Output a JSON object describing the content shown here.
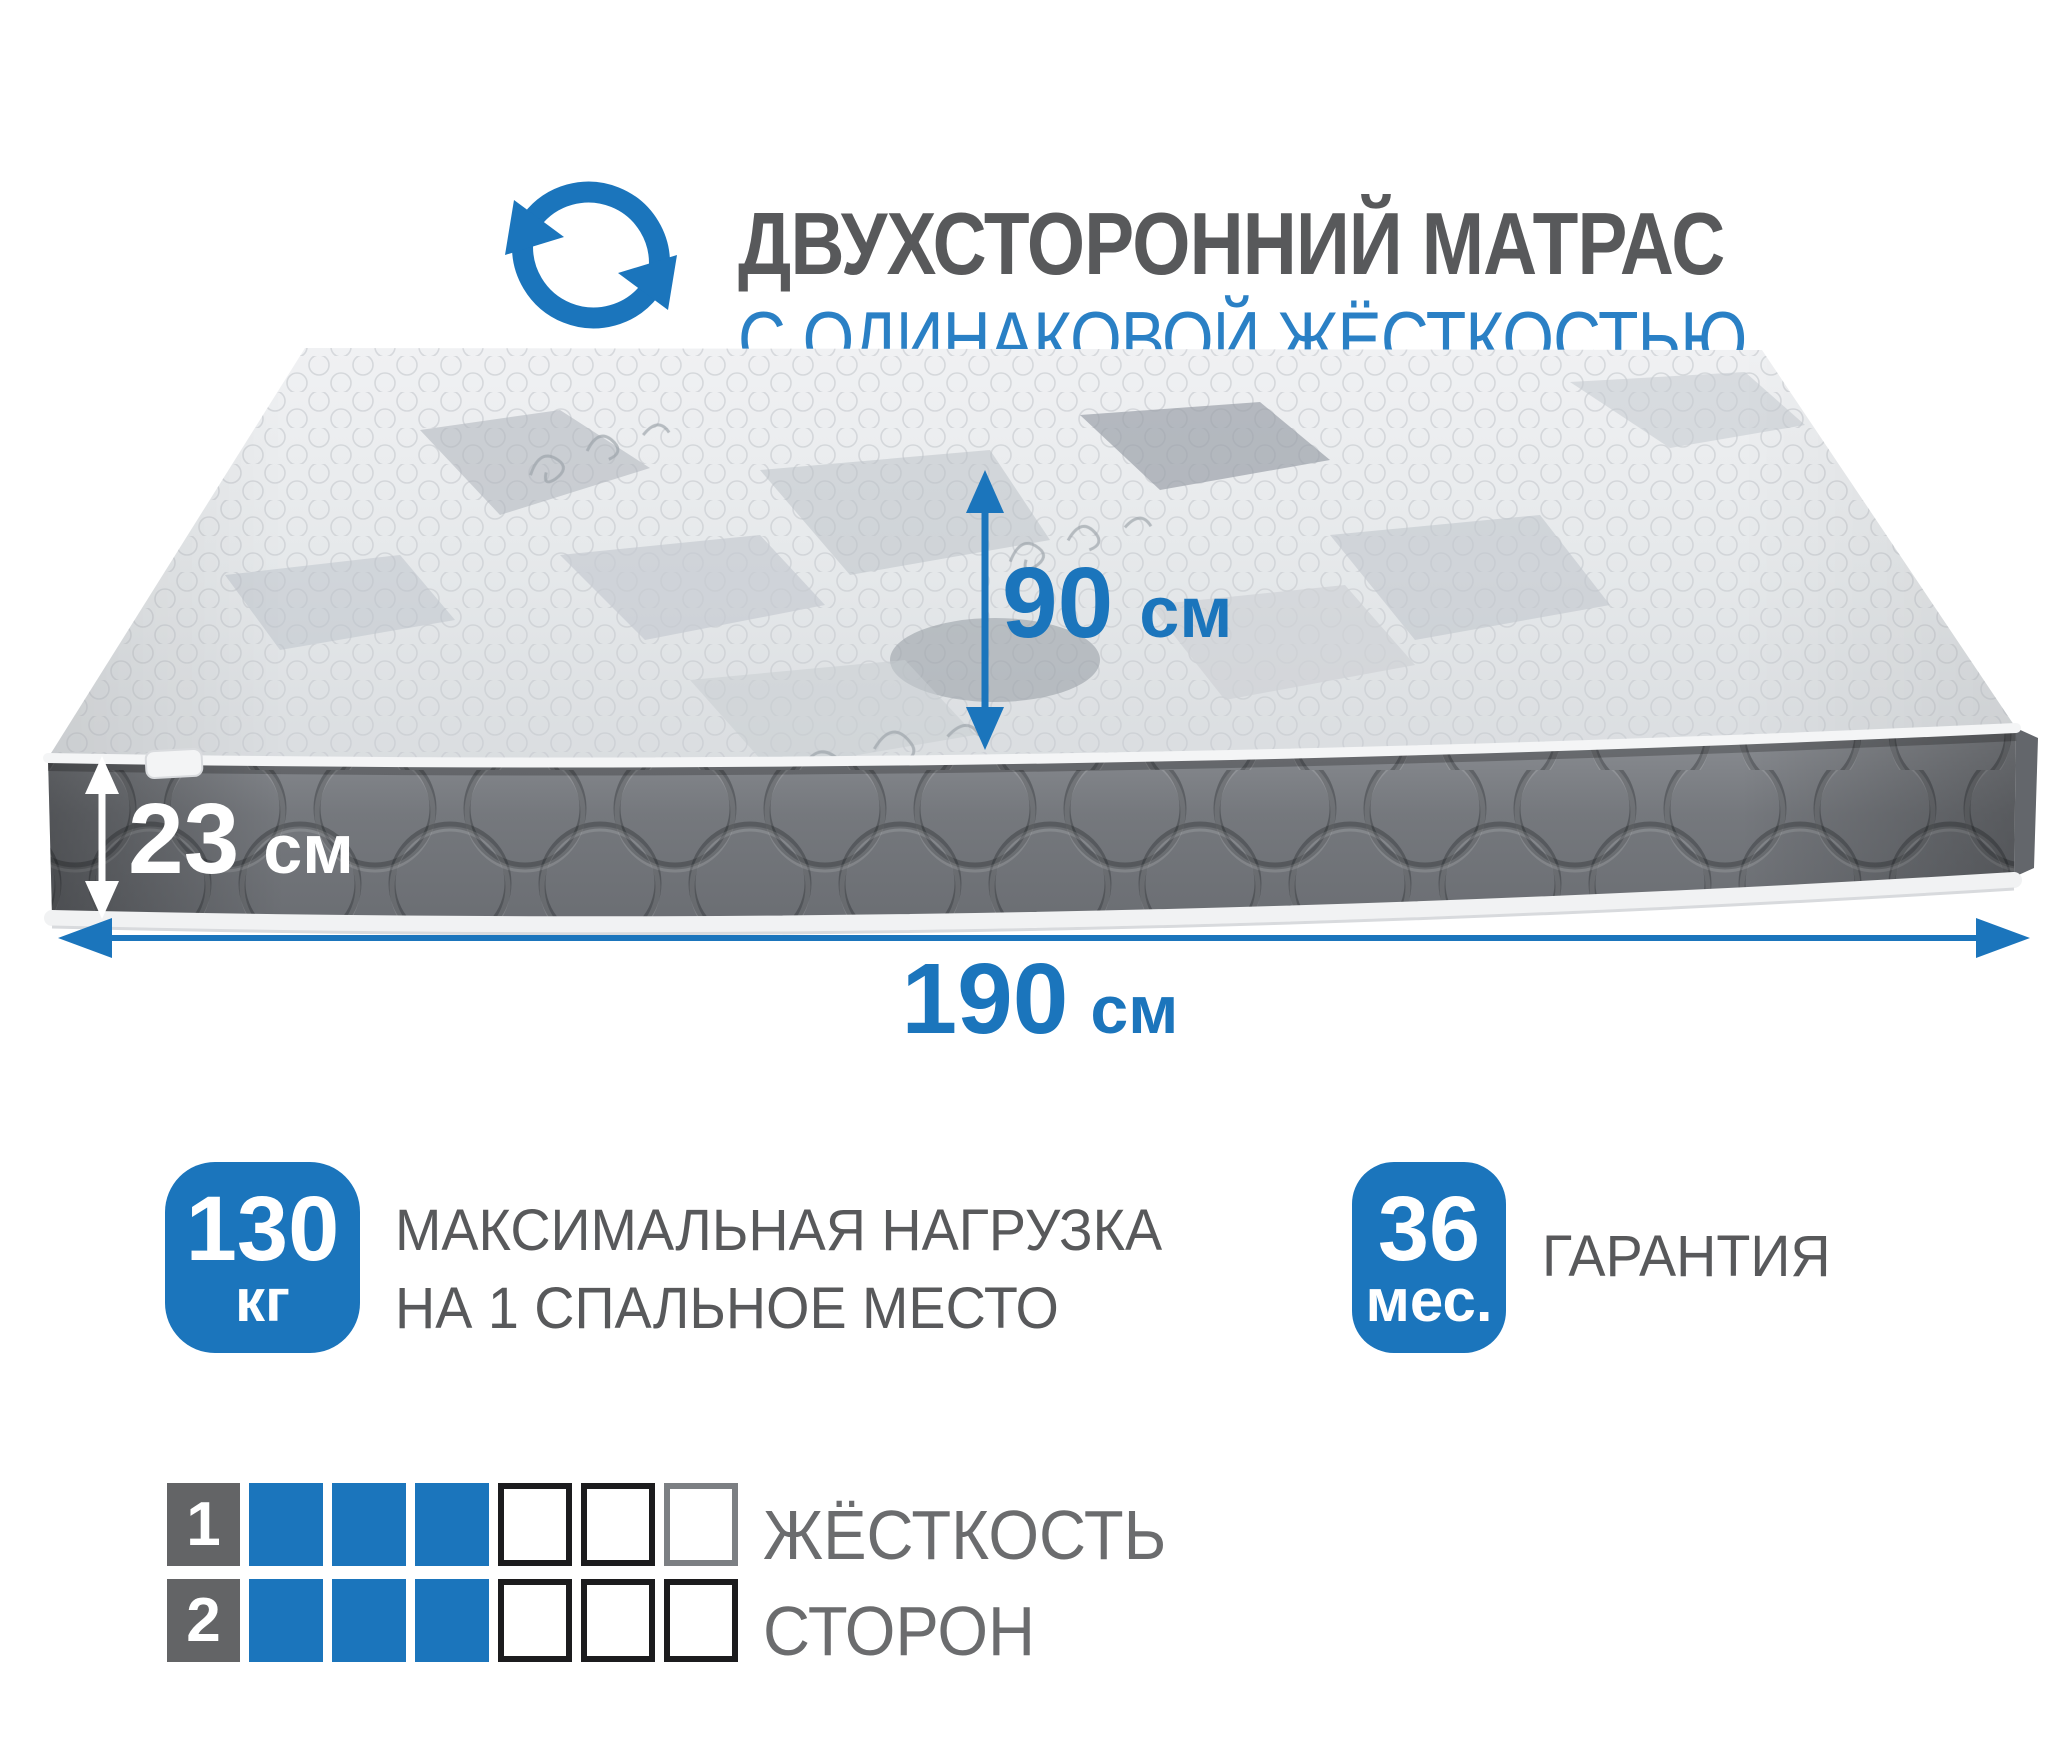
{
  "header": {
    "title": "ДВУХСТОРОННИЙ МАТРАС",
    "subtitle": "С ОДИНАКОВОЙ ЖЁСТКОСТЬЮ",
    "icon": "rotate-arrows-icon"
  },
  "dimensions": {
    "width": {
      "value": "90",
      "unit": "см"
    },
    "height": {
      "value": "23",
      "unit": "см"
    },
    "length": {
      "value": "190",
      "unit": "см"
    }
  },
  "features": [
    {
      "badge_value": "130",
      "badge_unit": "кг",
      "label_line1": "МАКСИМАЛЬНАЯ НАГРУЗКА",
      "label_line2": "НА 1 СПАЛЬНОЕ МЕСТО"
    },
    {
      "badge_value": "36",
      "badge_unit": "мес.",
      "label_line1": "ГАРАНТИЯ"
    }
  ],
  "firmness": {
    "label_line1": "ЖЁСТКОСТЬ",
    "label_line2": "СТОРОН",
    "rows": [
      {
        "side": "1",
        "filled": 3,
        "total": 6
      },
      {
        "side": "2",
        "filled": 3,
        "total": 6
      }
    ]
  },
  "colors": {
    "accent_blue": "#1b75bc",
    "header_blue": "#2a80c5",
    "text_dark": "#58595b",
    "text_gray": "#6b6c6e",
    "row_number_bg": "#636466",
    "mattress_side_gray": "#75787d",
    "mattress_top_light": "#e9ebed"
  }
}
